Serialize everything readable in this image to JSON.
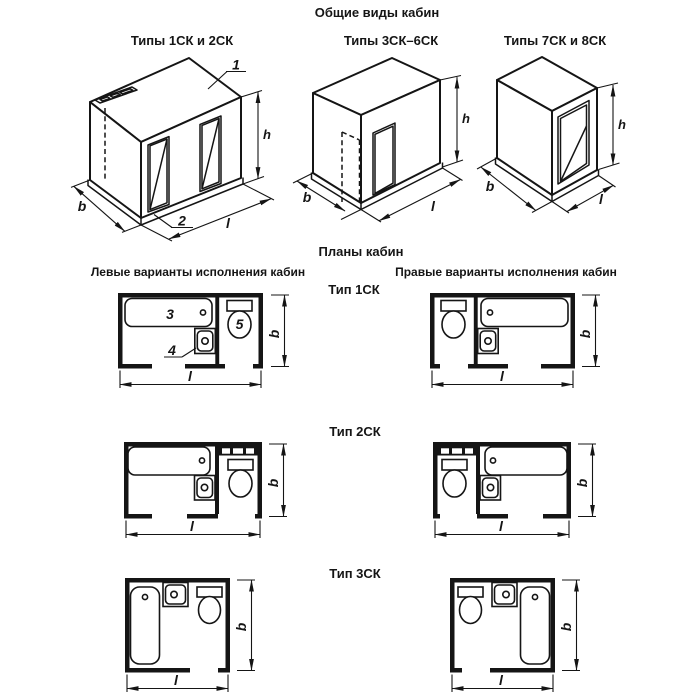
{
  "header": {
    "title": "Общие виды кабин"
  },
  "general_views": {
    "captions": [
      "Типы 1СК и 2СК",
      "Типы 3СК–6СК",
      "Типы 7СК и 8СК"
    ]
  },
  "plans": {
    "title": "Планы кабин",
    "left_header": "Левые варианты исполнения кабин",
    "right_header": "Правые варианты исполнения кабин",
    "row_labels": [
      "Тип 1СК",
      "Тип 2СК",
      "Тип 3СК"
    ]
  },
  "callouts": {
    "roof": "1",
    "floor": "2",
    "bath": "3",
    "sink": "4",
    "toilet": "5"
  },
  "dims": {
    "height": "h",
    "width": "b",
    "length": "l"
  },
  "colors": {
    "ink": "#151515",
    "paper": "#ffffff"
  }
}
